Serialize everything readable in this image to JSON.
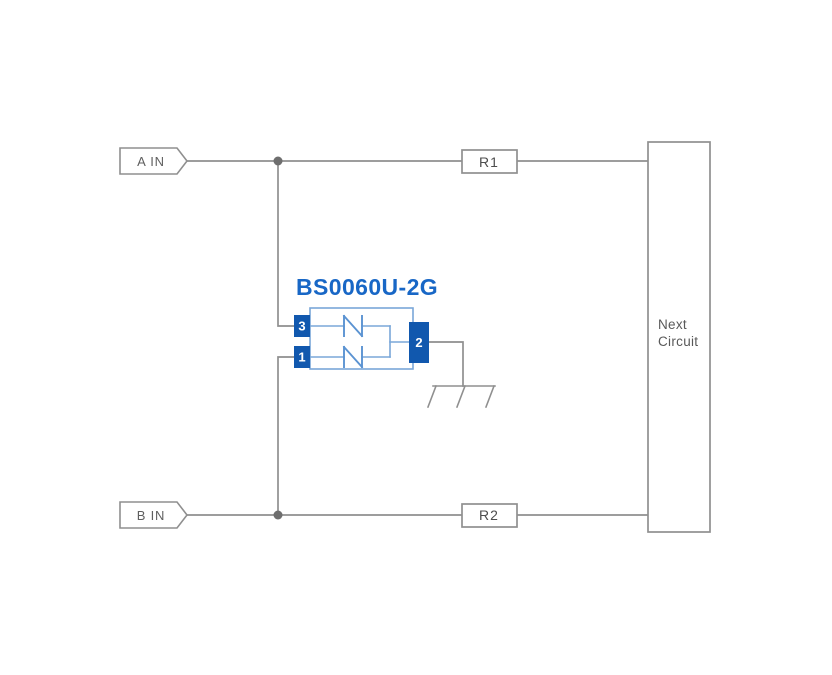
{
  "colors": {
    "background": "#ffffff",
    "wire_gray": "#8f8f8f",
    "junction_dot_gray": "#6e6e6e",
    "label_text_gray": "#595959",
    "resistor_text_gray": "#4d4d4d",
    "component_pin_blue": "#1158ae",
    "component_outline_blue": "#7aa7d9",
    "diode_symbol_blue": "#5b93d2",
    "part_number_blue": "#1867c6",
    "pin_number_text": "#ffffff"
  },
  "connectors": {
    "input_a": "A IN",
    "input_b": "B IN"
  },
  "resistors": {
    "r1": "R1",
    "r2": "R2"
  },
  "next_circuit": {
    "line1": "Next",
    "line2": "Circuit"
  },
  "component": {
    "part_number": "BS0060U-2G",
    "pin_top_left": "3",
    "pin_bottom_left": "1",
    "pin_right": "2"
  },
  "icons": {
    "ground": "chassis-ground-icon",
    "junction": "junction-dot",
    "input_flag": "signal-input-flag"
  }
}
